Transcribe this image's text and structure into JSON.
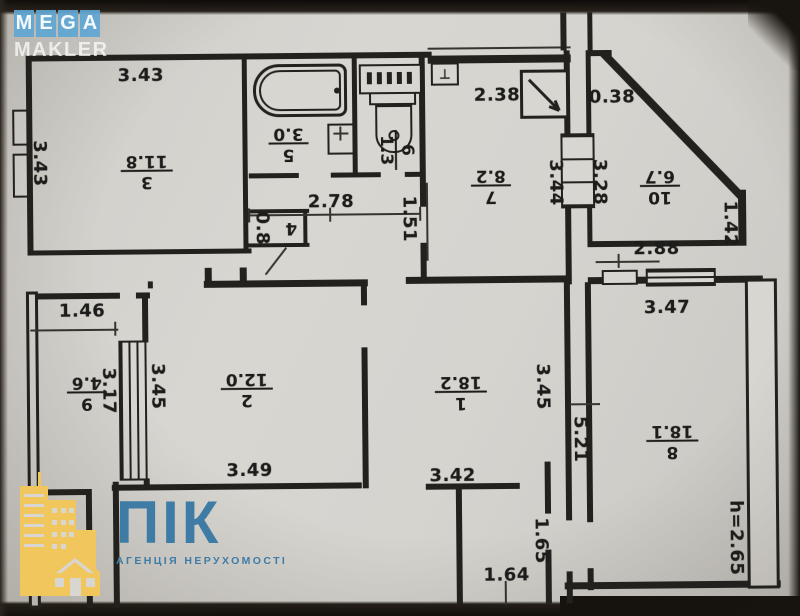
{
  "watermarks": {
    "mega_line1": "MEGA",
    "mega_line2": "MAKLER",
    "pik_name": "ПІК",
    "pik_tagline": "АГЕНЦІЯ НЕРУХОМОСТІ"
  },
  "colors": {
    "paper": "#d7d5d0",
    "ink": "#22211e",
    "mega_block_blue": "#60a6d2",
    "pik_blue": "#3e7ca6",
    "pik_yellow": "#f1c65d"
  },
  "plan": {
    "rooms": [
      {
        "number": "3",
        "area": "11.8",
        "x": 148,
        "y": 168,
        "rot": 180
      },
      {
        "number": "5",
        "area": "3.0",
        "x": 290,
        "y": 142,
        "rot": 180
      },
      {
        "number": "6",
        "area": "1.3",
        "x": 397,
        "y": 150,
        "rot": 90
      },
      {
        "number": "4",
        "area": "",
        "x": 292,
        "y": 226,
        "rot": 180
      },
      {
        "number": "7",
        "area": "8.2",
        "x": 492,
        "y": 186,
        "rot": 180
      },
      {
        "number": "10",
        "area": "6.7",
        "x": 661,
        "y": 188,
        "rot": 180
      },
      {
        "number": "9",
        "area": "4.6",
        "x": 86,
        "y": 389,
        "rot": 180
      },
      {
        "number": "2",
        "area": "12.0",
        "x": 246,
        "y": 387,
        "rot": 180
      },
      {
        "number": "1",
        "area": "18.2",
        "x": 460,
        "y": 392,
        "rot": 180
      },
      {
        "number": "8",
        "area": "18.1",
        "x": 671,
        "y": 443,
        "rot": 180
      }
    ],
    "dimensions": [
      {
        "text": "3.43",
        "x": 143,
        "y": 73,
        "v": false
      },
      {
        "text": "3.43",
        "x": 41,
        "y": 160,
        "v": true
      },
      {
        "text": "2.78",
        "x": 332,
        "y": 201,
        "v": false
      },
      {
        "text": "2.38",
        "x": 499,
        "y": 96,
        "v": false
      },
      {
        "text": "0.38",
        "x": 614,
        "y": 99,
        "v": false
      },
      {
        "text": "1.51",
        "x": 410,
        "y": 219,
        "v": true
      },
      {
        "text": "0.8",
        "x": 263,
        "y": 227,
        "v": true
      },
      {
        "text": "3.44",
        "x": 557,
        "y": 184,
        "v": true
      },
      {
        "text": "3.28",
        "x": 601,
        "y": 184,
        "v": true
      },
      {
        "text": "1.42",
        "x": 731,
        "y": 227,
        "v": true
      },
      {
        "text": "2.88",
        "x": 657,
        "y": 251,
        "v": false
      },
      {
        "text": "3.47",
        "x": 667,
        "y": 310,
        "v": false
      },
      {
        "text": "1.46",
        "x": 82,
        "y": 308,
        "v": false
      },
      {
        "text": "3.17",
        "x": 108,
        "y": 388,
        "v": true
      },
      {
        "text": "3.45",
        "x": 157,
        "y": 384,
        "v": true
      },
      {
        "text": "3.45",
        "x": 542,
        "y": 388,
        "v": true
      },
      {
        "text": "5.21",
        "x": 579,
        "y": 441,
        "v": true
      },
      {
        "text": "3.49",
        "x": 248,
        "y": 469,
        "v": false
      },
      {
        "text": "3.42",
        "x": 451,
        "y": 476,
        "v": false
      },
      {
        "text": "1.65",
        "x": 539,
        "y": 542,
        "v": true
      },
      {
        "text": "1.64",
        "x": 504,
        "y": 576,
        "v": false
      },
      {
        "text": "h=2.65",
        "x": 734,
        "y": 541,
        "v": true
      }
    ],
    "fixtures": [
      "bathtub",
      "sink",
      "toilet",
      "radiator",
      "electrical-panel",
      "doorbell"
    ]
  }
}
